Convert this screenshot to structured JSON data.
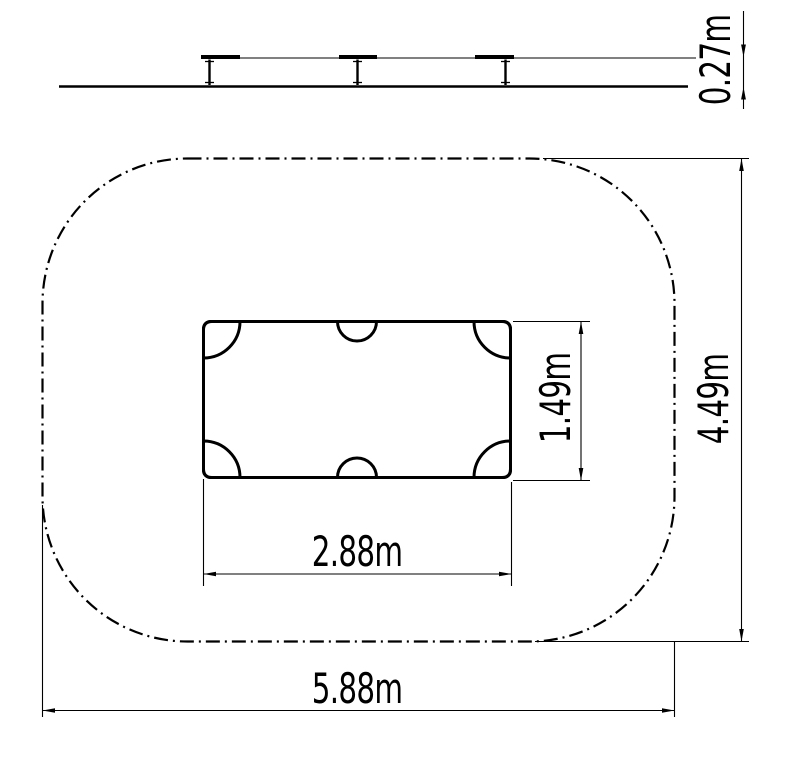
{
  "drawing": {
    "labels": {
      "platform_height": "0.27m",
      "sandbox_width": "2.88m",
      "sandbox_depth": "1.49m",
      "safety_zone_width": "5.88m",
      "safety_zone_depth": "4.49m"
    },
    "colors": {
      "line": "#000000",
      "background": "#ffffff"
    }
  }
}
